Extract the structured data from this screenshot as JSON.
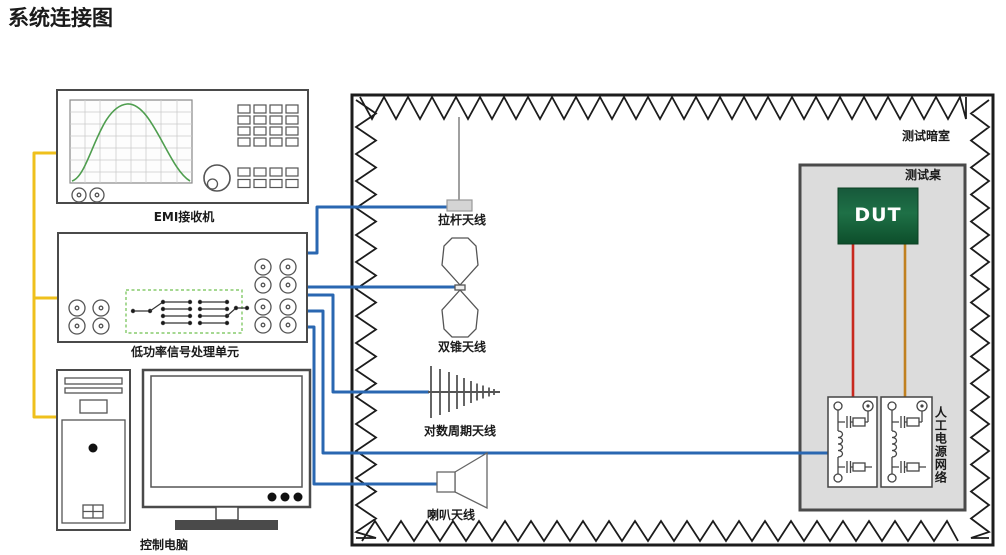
{
  "title": "系统连接图",
  "instruments": {
    "emi_receiver": {
      "label": "EMI接收机"
    },
    "signal_unit": {
      "label": "低功率信号处理单元"
    },
    "computer": {
      "label": "控制电脑"
    }
  },
  "chamber": {
    "label": "测试暗室",
    "table_label": "测试桌",
    "dut_label": "DUT",
    "lisn_label": "人工电源网络",
    "antennas": [
      {
        "label": "拉杆天线"
      },
      {
        "label": "双锥天线"
      },
      {
        "label": "对数周期天线"
      },
      {
        "label": "喇叭天线"
      }
    ]
  },
  "colors": {
    "cable_blue": "#2a67b1",
    "cable_yellow": "#efc01c",
    "cable_red": "#c8281e",
    "cable_orange": "#c08020",
    "trace_green": "#4f9e4f",
    "matrix_dashed_green": "#6fc04f",
    "dut_green": "#156038",
    "table_gray": "#dcdcdc"
  }
}
